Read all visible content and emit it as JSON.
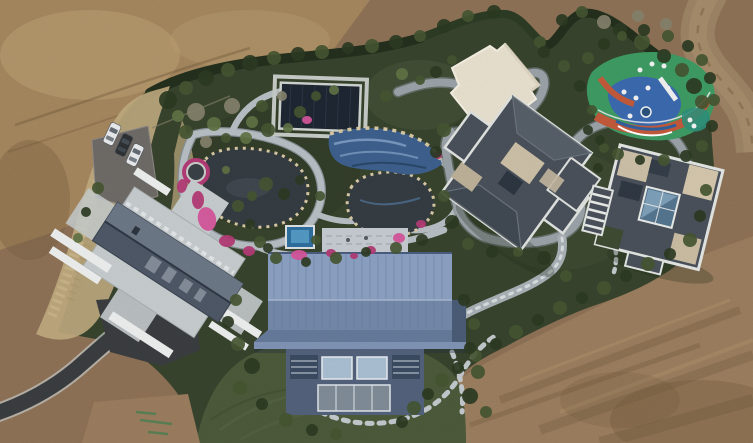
{
  "scene": {
    "type": "aerial drone photograph",
    "subject": "landscaped private estate with water garden, pools, villas and playground surrounded by bare earth",
    "cars_parked": 3
  },
  "features": [
    {
      "id": "dirt-terrain",
      "label": "bare graded earth surrounding the estate"
    },
    {
      "id": "dirt-road",
      "label": "dirt road curving along the top-right corner"
    },
    {
      "id": "estate-grounds",
      "label": "hedge-bounded landscaped grounds"
    },
    {
      "id": "parking-area",
      "label": "parking pad with three cars"
    },
    {
      "id": "gazebo",
      "label": "octagonal gazebo ringed with pink flowers"
    },
    {
      "id": "water-garden",
      "label": "winding stone paths, dark ponds and azalea beds"
    },
    {
      "id": "covered-pool",
      "label": "dark rectangular pool cover with stone apron"
    },
    {
      "id": "mosaic-pool",
      "label": "blue tiled water feature with rock edging"
    },
    {
      "id": "cream-pavilion",
      "label": "cream flat-roofed pavilion"
    },
    {
      "id": "playground",
      "label": "colorful painted playground with white equipment"
    },
    {
      "id": "villa-center",
      "label": "slate hip-roofed villa with beige roof terraces"
    },
    {
      "id": "villa-east",
      "label": "slate-roofed villa with central glass atrium"
    },
    {
      "id": "terrace-house",
      "label": "gable-roof house on flagstone terrace"
    },
    {
      "id": "blue-barn",
      "label": "large blue metal-roofed hall with window facade"
    },
    {
      "id": "jacuzzi",
      "label": "small blue plunge pool"
    },
    {
      "id": "lawn",
      "label": "open lawn below the blue hall"
    },
    {
      "id": "driveway",
      "label": "asphalt driveway entering at lower left"
    },
    {
      "id": "stepping-stones",
      "label": "stepping-stone paths linking the buildings"
    },
    {
      "id": "go-kart-track",
      "label": "grey winding track looping between buildings"
    }
  ],
  "palette": {
    "dirt_base": "#8d7156",
    "dirt_light": "#a8895f",
    "dirt_pale": "#bda174",
    "dirt_dark": "#6f5739",
    "dirt_road": "#9c8365",
    "estate_green": "#37432c",
    "lawn_green": "#4b5a3a",
    "hedge_green": "#232f1c",
    "shrub_dark": "#2b3a22",
    "shrub_mid": "#445531",
    "shrub_light": "#5f7244",
    "tree_bare": "#84816b",
    "dry_grass": "#c0ab80",
    "stone_path": "#b7bec3",
    "track_gray": "#9aa2a8",
    "asphalt": "#3a3d3f",
    "parking": "#6e6a66",
    "pond_water": "#343c42",
    "pool_cover": "#1d2631",
    "pool_blue": "#3d5f8c",
    "pool_wave": "#7e9cc2",
    "jacuzzi_blue": "#2e6f9e",
    "flower_pink": "#b23a74",
    "flower_pink_light": "#d4549a",
    "rock_beige": "#d6c8a4",
    "roof_slate": "#49505a",
    "roof_trim": "#dfe2df",
    "roof_beige": "#cbbfa6",
    "roof_cream": "#e8e0ce",
    "atrium_glass": "#54748e",
    "roof_blue": "#7f93b4",
    "roof_blue_light": "#8ba0c2",
    "roof_blue_dark": "#65799a",
    "wall_blue": "#52617a",
    "window_glass": "#a9bed2",
    "terrace_stone": "#c6cbcd",
    "car_white": "#e8eaec",
    "car_dark": "#2e3134",
    "playground_green": "#3d9a62",
    "playground_blue": "#3a69ae",
    "playground_orange": "#c2593a",
    "playground_teal": "#2e8f7a",
    "equipment_white": "#f2f2f2"
  },
  "cars": [
    {
      "x": 112,
      "y": 134,
      "rot": 25,
      "color": "car_white"
    },
    {
      "x": 124,
      "y": 145,
      "rot": 25,
      "color": "car_dark"
    },
    {
      "x": 135,
      "y": 155,
      "rot": 25,
      "color": "car_white"
    }
  ],
  "flower_beds": [
    [
      198,
      200,
      6,
      9,
      0
    ],
    [
      207,
      219,
      9,
      12,
      -15
    ],
    [
      227,
      241,
      8,
      6,
      0
    ],
    [
      249,
      251,
      6,
      5,
      0
    ],
    [
      299,
      255,
      8,
      5,
      0
    ],
    [
      331,
      253,
      5,
      4,
      0
    ],
    [
      371,
      250,
      5,
      4,
      10
    ],
    [
      399,
      238,
      6,
      5,
      0
    ],
    [
      421,
      224,
      5,
      4,
      0
    ],
    [
      438,
      155,
      4,
      4,
      0
    ],
    [
      307,
      120,
      5,
      4,
      0
    ],
    [
      354,
      256,
      4,
      3,
      0
    ],
    [
      182,
      186,
      5,
      7,
      10
    ]
  ],
  "vegetation": [
    [
      168,
      100,
      9,
      0
    ],
    [
      186,
      88,
      7,
      1
    ],
    [
      206,
      78,
      8,
      0
    ],
    [
      228,
      70,
      7,
      1
    ],
    [
      250,
      63,
      8,
      0
    ],
    [
      274,
      58,
      7,
      1
    ],
    [
      298,
      54,
      7,
      0
    ],
    [
      322,
      52,
      7,
      1
    ],
    [
      348,
      48,
      6,
      0
    ],
    [
      372,
      46,
      7,
      1
    ],
    [
      396,
      42,
      7,
      0
    ],
    [
      420,
      36,
      6,
      1
    ],
    [
      444,
      26,
      7,
      0
    ],
    [
      468,
      16,
      6,
      1
    ],
    [
      494,
      12,
      7,
      0
    ],
    [
      540,
      42,
      6,
      1
    ],
    [
      562,
      20,
      6,
      0
    ],
    [
      582,
      12,
      6,
      1
    ],
    [
      604,
      22,
      7,
      3
    ],
    [
      638,
      16,
      6,
      3
    ],
    [
      666,
      24,
      6,
      3
    ],
    [
      620,
      30,
      7,
      0
    ],
    [
      642,
      42,
      8,
      1
    ],
    [
      664,
      56,
      7,
      0
    ],
    [
      682,
      70,
      7,
      1
    ],
    [
      694,
      86,
      8,
      0
    ],
    [
      702,
      102,
      7,
      1
    ],
    [
      196,
      112,
      9,
      3
    ],
    [
      214,
      124,
      7,
      2
    ],
    [
      232,
      106,
      8,
      3
    ],
    [
      252,
      122,
      6,
      2
    ],
    [
      186,
      132,
      7,
      1
    ],
    [
      206,
      142,
      6,
      3
    ],
    [
      226,
      138,
      5,
      1
    ],
    [
      246,
      138,
      6,
      2
    ],
    [
      268,
      130,
      7,
      1
    ],
    [
      288,
      128,
      5,
      2
    ],
    [
      262,
      106,
      6,
      1
    ],
    [
      282,
      96,
      5,
      3
    ],
    [
      300,
      112,
      6,
      1
    ],
    [
      178,
      116,
      6,
      2
    ],
    [
      316,
      96,
      5,
      1
    ],
    [
      334,
      90,
      5,
      2
    ],
    [
      266,
      184,
      7,
      1
    ],
    [
      284,
      194,
      6,
      0
    ],
    [
      252,
      196,
      5,
      1
    ],
    [
      226,
      170,
      4,
      2
    ],
    [
      300,
      180,
      5,
      0
    ],
    [
      320,
      196,
      5,
      1
    ],
    [
      386,
      96,
      6,
      1
    ],
    [
      402,
      74,
      6,
      2
    ],
    [
      420,
      80,
      5,
      1
    ],
    [
      436,
      72,
      6,
      0
    ],
    [
      452,
      60,
      5,
      1
    ],
    [
      444,
      130,
      7,
      1
    ],
    [
      436,
      152,
      6,
      0
    ],
    [
      444,
      196,
      6,
      1
    ],
    [
      452,
      222,
      7,
      0
    ],
    [
      468,
      244,
      6,
      1
    ],
    [
      492,
      252,
      6,
      0
    ],
    [
      518,
      252,
      5,
      1
    ],
    [
      544,
      258,
      7,
      0
    ],
    [
      566,
      276,
      6,
      1
    ],
    [
      588,
      130,
      5,
      0
    ],
    [
      592,
      110,
      5,
      1
    ],
    [
      580,
      86,
      6,
      0
    ],
    [
      564,
      66,
      6,
      1
    ],
    [
      544,
      52,
      6,
      0
    ],
    [
      604,
      148,
      5,
      1
    ],
    [
      598,
      168,
      5,
      0
    ],
    [
      588,
      58,
      6,
      1
    ],
    [
      604,
      44,
      6,
      0
    ],
    [
      622,
      36,
      5,
      1
    ],
    [
      644,
      30,
      6,
      0
    ],
    [
      668,
      36,
      6,
      1
    ],
    [
      688,
      46,
      6,
      0
    ],
    [
      702,
      60,
      6,
      1
    ],
    [
      710,
      78,
      6,
      0
    ],
    [
      714,
      100,
      6,
      1
    ],
    [
      712,
      126,
      6,
      0
    ],
    [
      702,
      146,
      6,
      1
    ],
    [
      686,
      156,
      6,
      0
    ],
    [
      664,
      160,
      6,
      1
    ],
    [
      640,
      160,
      5,
      0
    ],
    [
      618,
      154,
      6,
      1
    ],
    [
      600,
      140,
      5,
      0
    ],
    [
      706,
      190,
      6,
      1
    ],
    [
      700,
      216,
      6,
      0
    ],
    [
      690,
      240,
      7,
      1
    ],
    [
      670,
      254,
      6,
      0
    ],
    [
      648,
      264,
      7,
      1
    ],
    [
      626,
      276,
      6,
      0
    ],
    [
      604,
      288,
      7,
      1
    ],
    [
      582,
      298,
      6,
      0
    ],
    [
      560,
      308,
      7,
      1
    ],
    [
      538,
      320,
      6,
      0
    ],
    [
      516,
      332,
      7,
      1
    ],
    [
      496,
      344,
      6,
      0
    ],
    [
      476,
      356,
      6,
      1
    ],
    [
      458,
      368,
      6,
      0
    ],
    [
      442,
      380,
      7,
      1
    ],
    [
      428,
      394,
      6,
      0
    ],
    [
      414,
      408,
      7,
      1
    ],
    [
      402,
      422,
      6,
      0
    ],
    [
      98,
      188,
      6,
      1
    ],
    [
      86,
      212,
      5,
      0
    ],
    [
      78,
      238,
      5,
      2
    ],
    [
      238,
      206,
      6,
      1
    ],
    [
      250,
      224,
      5,
      0
    ],
    [
      260,
      242,
      6,
      1
    ],
    [
      276,
      258,
      6,
      1
    ],
    [
      306,
      262,
      5,
      0
    ],
    [
      336,
      258,
      6,
      1
    ],
    [
      366,
      252,
      5,
      0
    ],
    [
      396,
      248,
      6,
      1
    ],
    [
      422,
      240,
      6,
      0
    ],
    [
      236,
      300,
      6,
      1
    ],
    [
      228,
      322,
      6,
      0
    ],
    [
      238,
      344,
      7,
      1
    ],
    [
      252,
      366,
      8,
      0
    ],
    [
      240,
      388,
      7,
      1
    ],
    [
      262,
      404,
      6,
      0
    ],
    [
      286,
      420,
      7,
      1
    ],
    [
      312,
      430,
      6,
      0
    ],
    [
      336,
      434,
      6,
      1
    ],
    [
      464,
      300,
      6,
      0
    ],
    [
      474,
      324,
      6,
      1
    ],
    [
      470,
      348,
      6,
      0
    ],
    [
      478,
      372,
      7,
      1
    ],
    [
      470,
      396,
      8,
      0
    ],
    [
      486,
      412,
      6,
      1
    ],
    [
      316,
      240,
      5,
      1
    ],
    [
      268,
      248,
      5,
      0
    ]
  ]
}
